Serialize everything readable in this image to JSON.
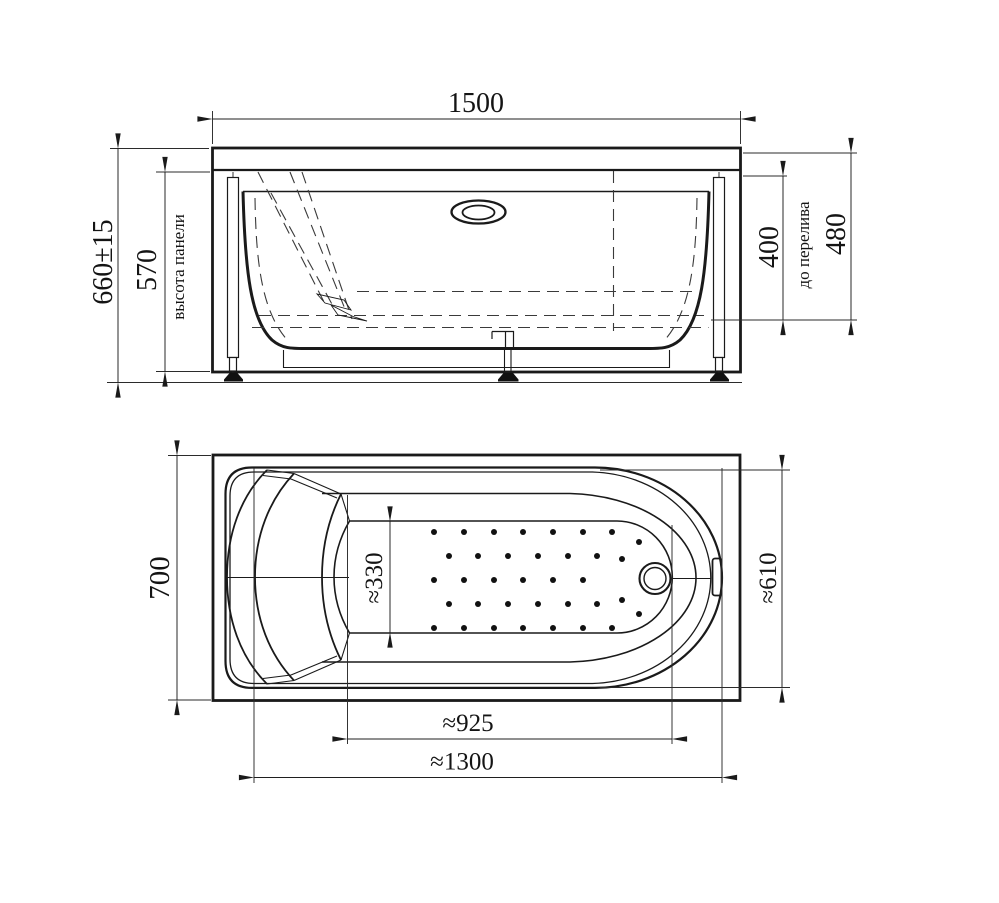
{
  "drawing": {
    "kind": "two-view technical dimension drawing of a rectangular bathtub with front panel, legs, overflow and drain",
    "views": [
      "front-elevation",
      "top-plan"
    ],
    "colors": {
      "line": "#1a1a1a",
      "background": "#ffffff"
    }
  },
  "labels": {
    "front_width": "1500",
    "front_total_height": "660±15",
    "front_panel_height": "570",
    "front_panel_caption": "высота панели",
    "front_overflow_depth": "400",
    "front_overflow_caption": "до перелива",
    "front_rim_height": "480",
    "plan_width": "700",
    "plan_floor_width": "≈330",
    "plan_end_width": "≈610",
    "plan_floor_length": "≈925",
    "plan_inner_length": "≈1300"
  }
}
